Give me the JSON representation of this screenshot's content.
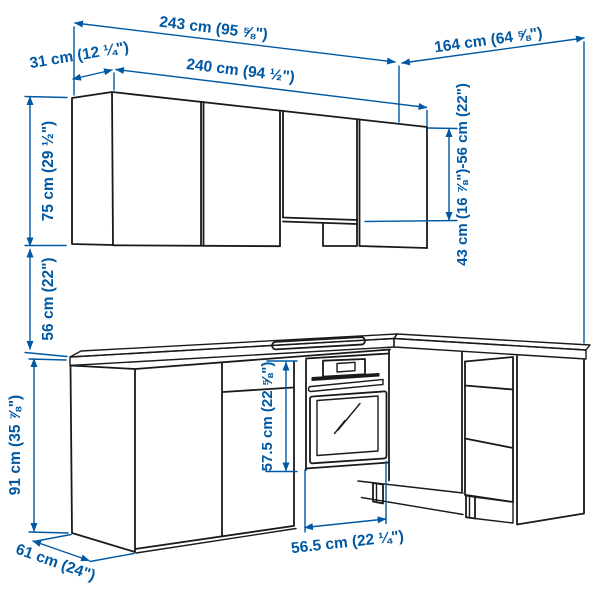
{
  "image": {
    "description": "Line drawing of an L-shaped corner kitchen with wall cabinets, base cabinets, oven and hob, annotated with dimensions",
    "background_color": "#ffffff",
    "line_color": "#1a1a1a",
    "dimension_color": "#0058a3"
  },
  "dims": {
    "total_width": "243 cm (95 ⅝\")",
    "return_length": "164 cm (64 ⅝\")",
    "wall_cabinet_depth": "31 cm (12 ¼\")",
    "wall_run_width": "240 cm (94 ½\")",
    "wall_cabinet_height": "75 cm (29 ½\")",
    "wall_to_counter_gap": "56 cm (22\")",
    "counter_to_wall_range": "43 cm (16 ⅞\")-56 cm (22\")",
    "base_cabinet_height": "91 cm (35 ⅞\")",
    "base_depth": "61 cm (24\")",
    "oven_niche_height": "57.5 cm (22 ⅝\")",
    "oven_niche_width": "56.5 cm (22 ¼\")"
  }
}
